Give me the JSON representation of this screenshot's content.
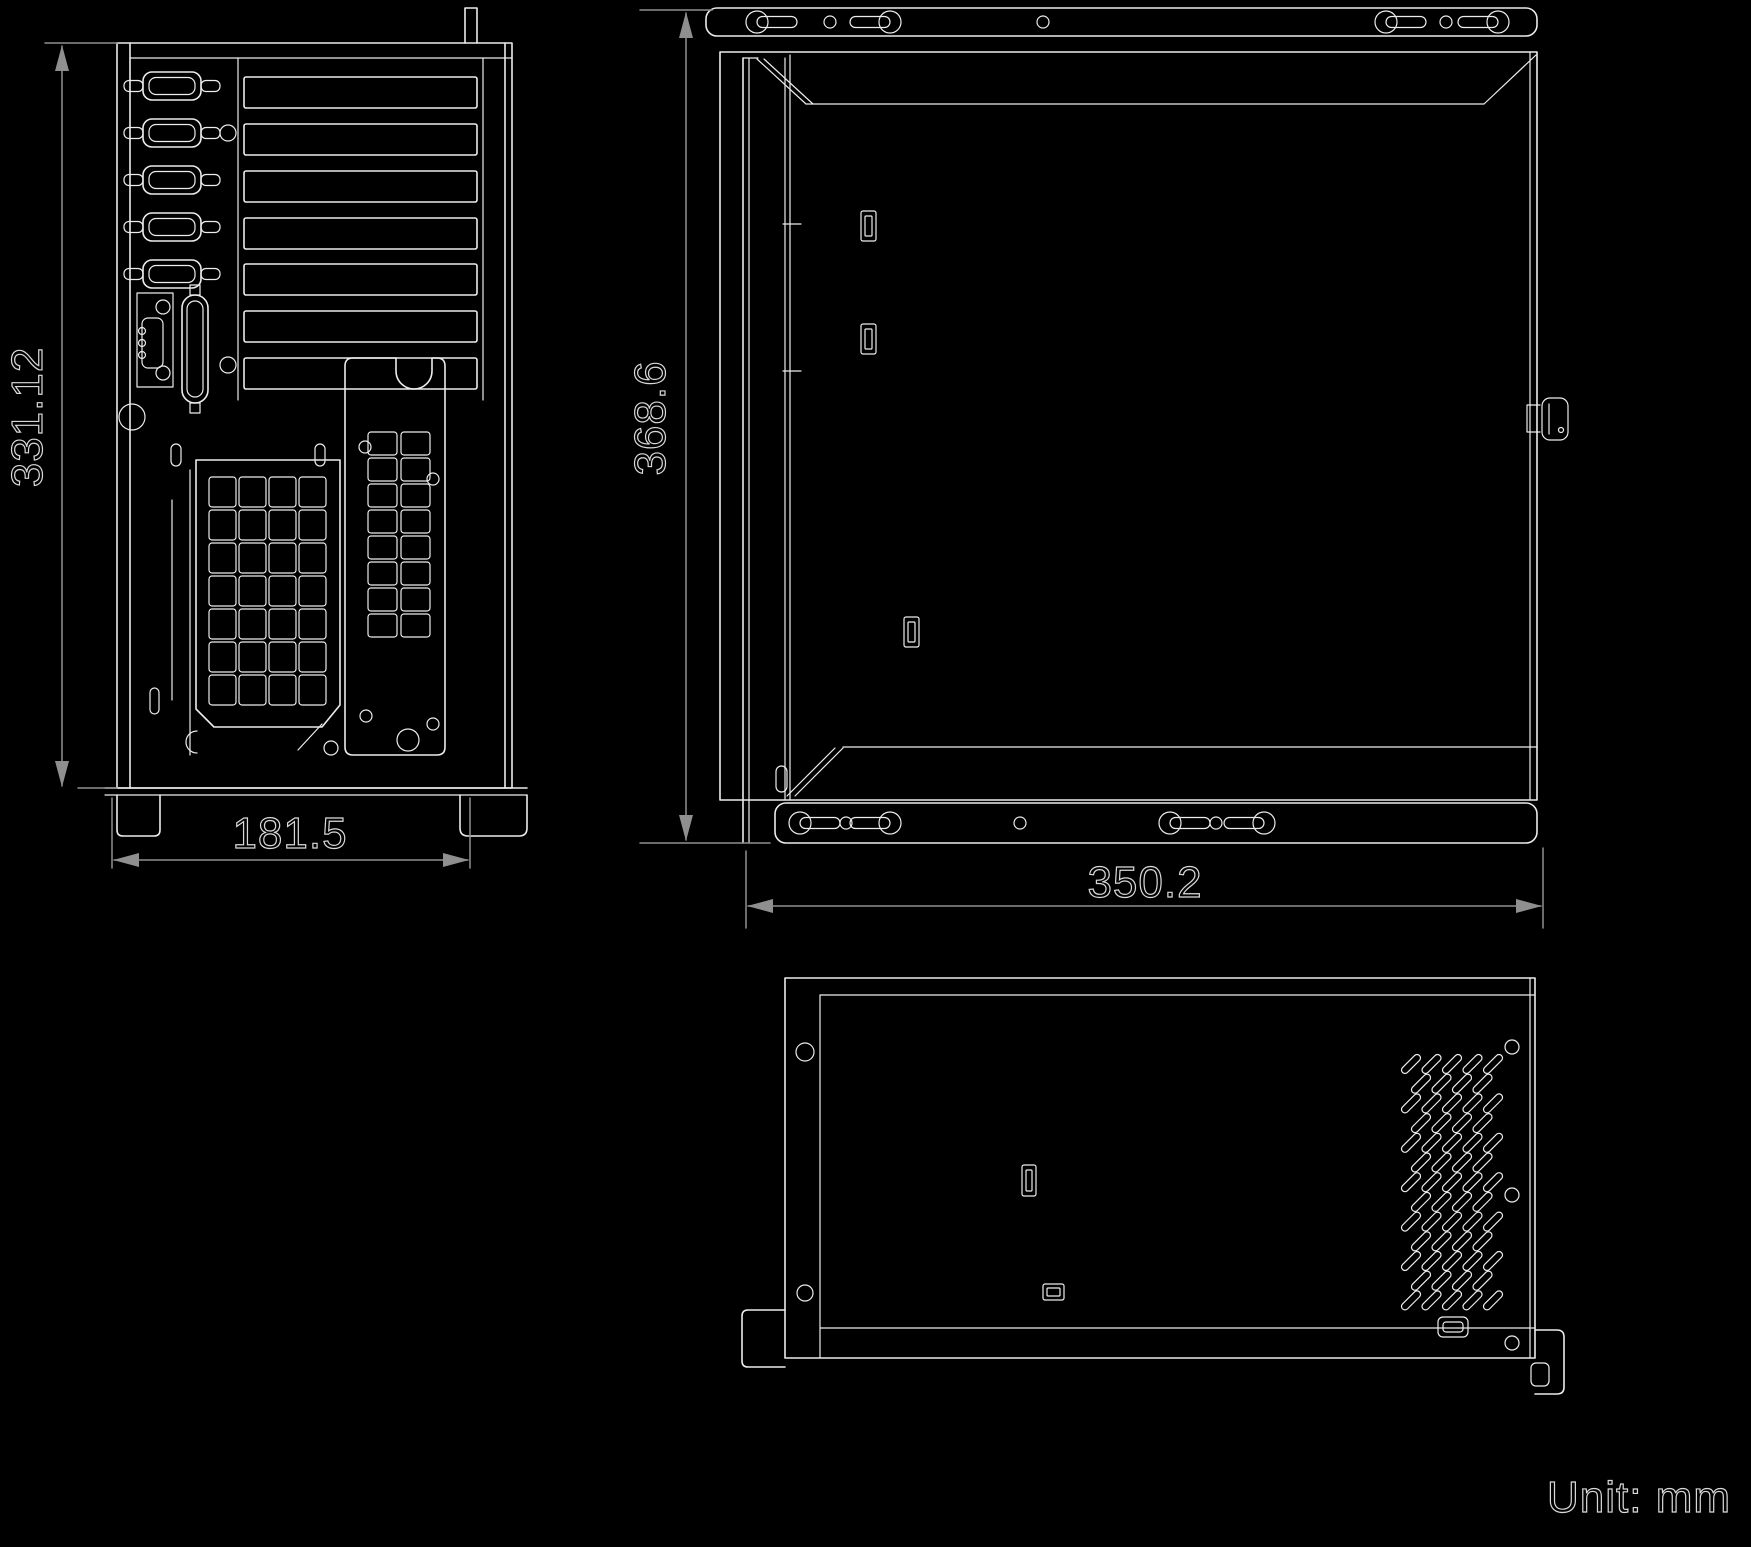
{
  "page": {
    "type": "technical dimension drawing",
    "background": "#000000"
  },
  "unit": {
    "label": "Unit: mm"
  },
  "dimensions": {
    "rear_height_mm": "331.12",
    "rear_width_mm": "181.5",
    "side_height_mm": "368.6",
    "side_depth_mm": "350.2"
  },
  "views": {
    "rear": {
      "serial_ports": 5,
      "expansion_slots": 7
    },
    "side": {
      "mounting_flanges": 2
    },
    "bottom": {
      "vent_area": true
    }
  },
  "colors": {
    "background": "#000000",
    "line": "#ececec",
    "dimension_line": "#8f8f8f",
    "dimension_text": "#d9d9d9"
  }
}
